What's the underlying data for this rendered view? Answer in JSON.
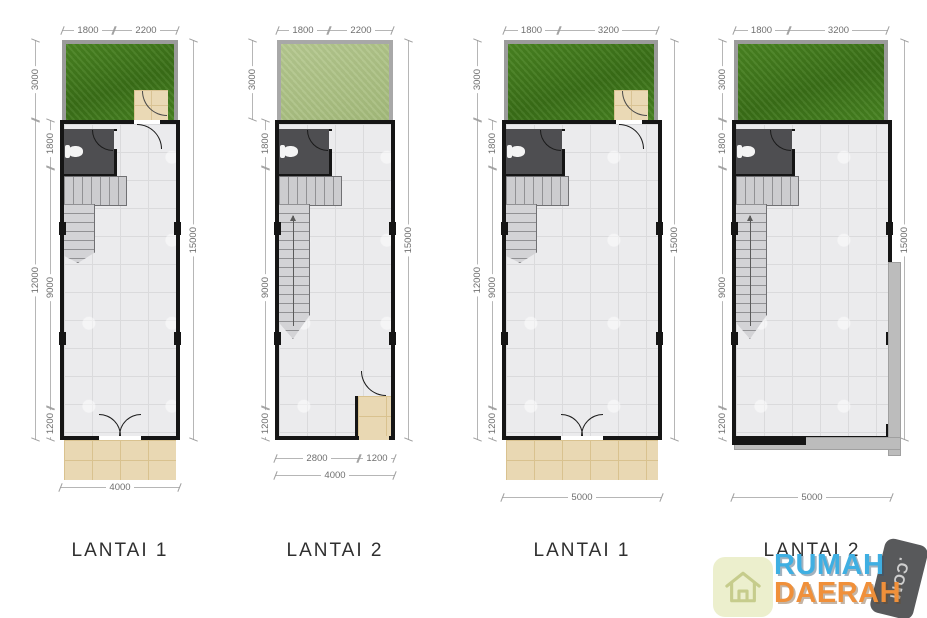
{
  "plans": [
    {
      "label": "LANTAI 1",
      "top1": "1800",
      "top2": "2200",
      "garden_h": "3000",
      "house_h": "12000",
      "seg1": "1800",
      "seg2": "9000",
      "seg3": "1200",
      "right": "15000",
      "bottom": "4000"
    },
    {
      "label": "LANTAI 2",
      "top1": "1800",
      "top2": "2200",
      "garden_h": "3000",
      "seg1": "1800",
      "seg2": "9000",
      "seg3": "1200",
      "right": "15000",
      "bottom_inner1": "2800",
      "bottom_inner2": "1200",
      "bottom": "4000"
    },
    {
      "label": "LANTAI 1",
      "top1": "1800",
      "top2": "3200",
      "garden_h": "3000",
      "house_h": "12000",
      "seg1": "1800",
      "seg2": "9000",
      "seg3": "1200",
      "right": "15000",
      "bottom": "5000"
    },
    {
      "label": "LANTAI 2",
      "top1": "1800",
      "top2": "3200",
      "garden_h": "3000",
      "seg1": "1800",
      "seg2": "9000",
      "seg3": "1200",
      "right": "15000",
      "bottom": "5000"
    }
  ],
  "logo": {
    "word1": "RUMAH",
    "word2": "DAERAH",
    "tld": ".COM"
  },
  "colors": {
    "grass_dark": "#3f7d1f",
    "grass_light": "#a9c285",
    "wall": "#151515",
    "floor_tile": "#ebebed",
    "porch_tile": "#e9d8b3",
    "logo_blue": "#3fafe2",
    "logo_orange": "#f0903a",
    "logo_badge": "#58595b"
  }
}
